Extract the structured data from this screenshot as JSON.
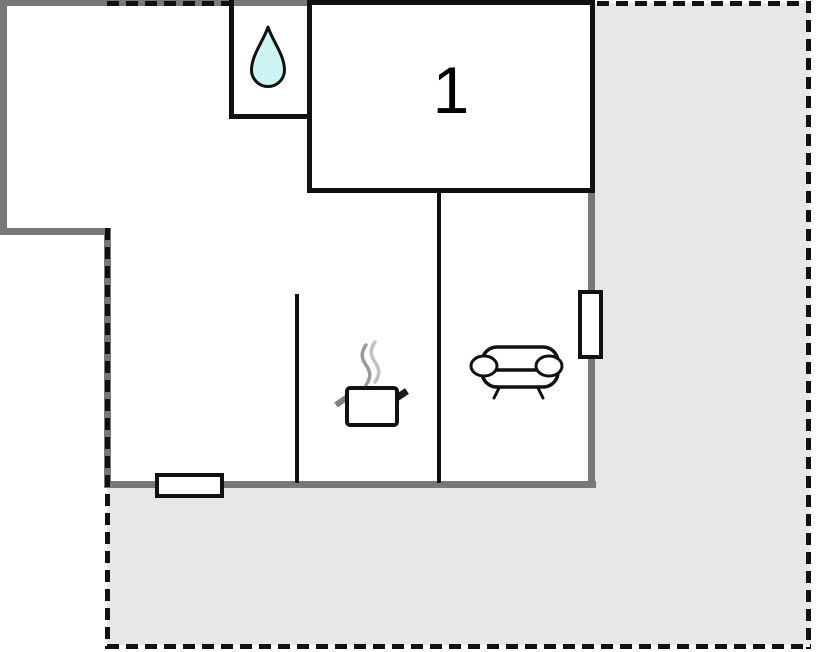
{
  "floorplan": {
    "rooms": [
      {
        "name": "room-1",
        "label": "1"
      },
      {
        "name": "bathroom",
        "icon": "water-drop-icon"
      },
      {
        "name": "kitchen",
        "icon": "cooking-pot-icon"
      },
      {
        "name": "living-area",
        "icon": "sofa-icon"
      },
      {
        "name": "terrace",
        "outline": "dashed"
      }
    ],
    "windows": [
      {
        "name": "window-bottom-wall"
      },
      {
        "name": "window-right-wall"
      }
    ],
    "colors": {
      "background": "#ffffff",
      "outer_wall": "#787878",
      "inner_wall": "#111111",
      "terrace_fill": "#e7e7e7",
      "water_drop_fill": "#cdf3f3",
      "steam_gray": "#9a9a9a"
    }
  }
}
